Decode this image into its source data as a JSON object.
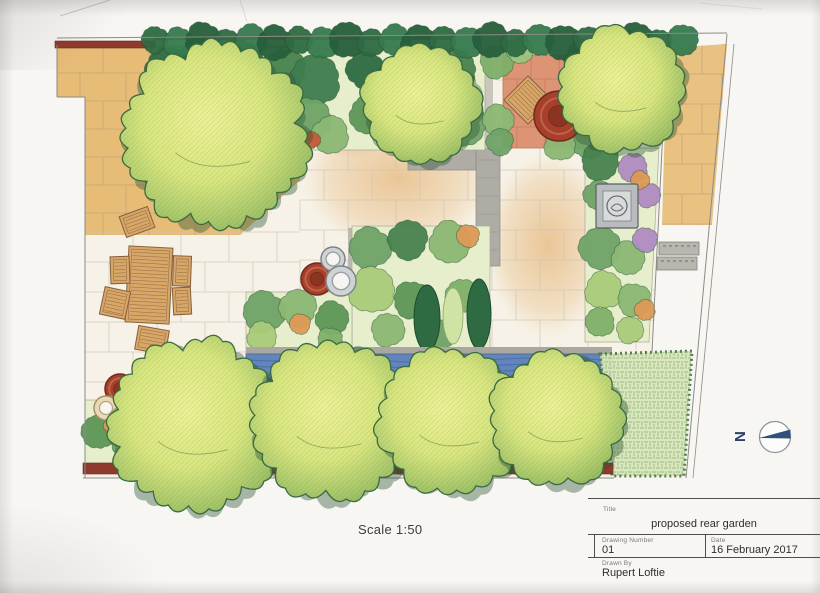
{
  "sheet": {
    "scale_label": "Scale 1:50",
    "north_letter": "N"
  },
  "title_block": {
    "labels": {
      "title": "Title",
      "drawing_number": "Drawing Number",
      "date": "Date",
      "drawn_by": "Drawn By"
    },
    "values": {
      "title": "proposed rear garden",
      "drawing_number": "01",
      "date": "16 February 2017",
      "drawn_by": "Rupert Loftie"
    }
  },
  "drawing": {
    "type": "hand-drawn colored-pencil garden design plan (top view)",
    "features": [
      "stone-flag-patio-top-left",
      "dining-table-with-six-chairs",
      "terracotta-corner-patio-with-diamond-table-and-pot",
      "boundary-hedge-top",
      "brick-wall-segments",
      "large-tree-top-left",
      "tree-top-middle",
      "tree-top-right-corner",
      "right-planting-bed-with-square-water-feature",
      "central-planting-beds",
      "three-pots-cluster",
      "water-rill-strip",
      "row-of-four-trees-bottom",
      "lawn-bottom-right",
      "pots-bottom-left",
      "steps-outside-right-boundary",
      "north-arrow",
      "title-block"
    ]
  },
  "colors": {
    "paper": "#f7f5f1",
    "line": "#8b8b85",
    "wall_red": "#8e3a2c",
    "hedge": "#2e6b43",
    "tan": "#e7bc76",
    "tan_deep": "#dfa254",
    "cream": "#f7f2e7",
    "terracotta_paving": "#dc9474",
    "pot_red": "#a83f2b",
    "grey_path": "#aeaca4",
    "pot_grey": "#cfd3d5",
    "water": "#6286bb",
    "water_dark": "#40609a",
    "lawn": "#d9e7bd",
    "lawn_line": "#7da26a",
    "wood": "#d8a768",
    "wood_line": "#855f3d",
    "navy": "#31507e",
    "purple": "#b08cc2",
    "orange": "#dd9a56"
  }
}
